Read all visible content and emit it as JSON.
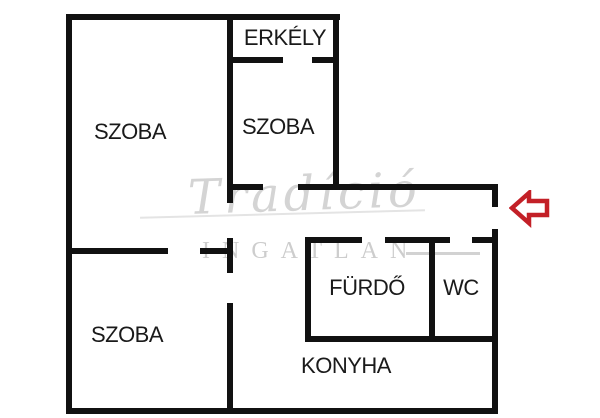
{
  "floorplan": {
    "background_color": "#ffffff",
    "wall_color": "#111111",
    "rooms": [
      {
        "id": "erkely",
        "label": "ERKÉLY",
        "cx": 285,
        "cy": 38
      },
      {
        "id": "szoba-top-left",
        "label": "SZOBA",
        "cx": 130,
        "cy": 132
      },
      {
        "id": "szoba-middle",
        "label": "SZOBA",
        "cx": 278,
        "cy": 127
      },
      {
        "id": "szoba-bottom-left",
        "label": "SZOBA",
        "cx": 127,
        "cy": 335
      },
      {
        "id": "furdo",
        "label": "FÜRDŐ",
        "cx": 367,
        "cy": 288
      },
      {
        "id": "wc",
        "label": "WC",
        "cx": 461,
        "cy": 288
      },
      {
        "id": "konyha",
        "label": "KONYHA",
        "cx": 346,
        "cy": 366
      }
    ],
    "walls": [
      {
        "id": "outer-top",
        "x": 66,
        "y": 14,
        "w": 274,
        "h": 6
      },
      {
        "id": "outer-left",
        "x": 66,
        "y": 14,
        "w": 6,
        "h": 400
      },
      {
        "id": "outer-bottom",
        "x": 66,
        "y": 408,
        "w": 432,
        "h": 6
      },
      {
        "id": "entrance-upper-stub",
        "x": 492,
        "y": 184,
        "w": 6,
        "h": 23
      },
      {
        "id": "outer-right-lower",
        "x": 492,
        "y": 229,
        "w": 6,
        "h": 185
      },
      {
        "id": "mid-vertical-upper",
        "x": 227,
        "y": 14,
        "w": 6,
        "h": 189
      },
      {
        "id": "mid-vertical-seg2",
        "x": 227,
        "y": 238,
        "w": 6,
        "h": 35
      },
      {
        "id": "mid-vertical-seg3",
        "x": 227,
        "y": 303,
        "w": 6,
        "h": 105
      },
      {
        "id": "balcony-right",
        "x": 333,
        "y": 14,
        "w": 6,
        "h": 176
      },
      {
        "id": "balcony-bottom-left",
        "x": 227,
        "y": 57,
        "w": 56,
        "h": 6
      },
      {
        "id": "balcony-bottom-right",
        "x": 312,
        "y": 57,
        "w": 27,
        "h": 6
      },
      {
        "id": "hall-wall-left",
        "x": 227,
        "y": 184,
        "w": 36,
        "h": 6
      },
      {
        "id": "hall-wall-right",
        "x": 298,
        "y": 184,
        "w": 200,
        "h": 6
      },
      {
        "id": "leftrooms-divider-a",
        "x": 66,
        "y": 248,
        "w": 102,
        "h": 6
      },
      {
        "id": "leftrooms-divider-b",
        "x": 200,
        "y": 248,
        "w": 33,
        "h": 6
      },
      {
        "id": "bath-top-a",
        "x": 305,
        "y": 237,
        "w": 57,
        "h": 6
      },
      {
        "id": "bath-top-b",
        "x": 385,
        "y": 237,
        "w": 65,
        "h": 6
      },
      {
        "id": "bath-top-c",
        "x": 472,
        "y": 237,
        "w": 26,
        "h": 6
      },
      {
        "id": "bath-left",
        "x": 305,
        "y": 237,
        "w": 6,
        "h": 105
      },
      {
        "id": "bath-wc-divider",
        "x": 429,
        "y": 237,
        "w": 6,
        "h": 105
      },
      {
        "id": "bath-bottom",
        "x": 305,
        "y": 336,
        "w": 193,
        "h": 6
      }
    ]
  },
  "watermark": {
    "script_text": "Tradíció",
    "caps_text": "INGATLAN",
    "script_color": "#d4d4d4",
    "caps_color": "#cdcdcd"
  },
  "entrance_arrow": {
    "direction": "left",
    "color": "#c32027",
    "fill": "#ffffff"
  }
}
